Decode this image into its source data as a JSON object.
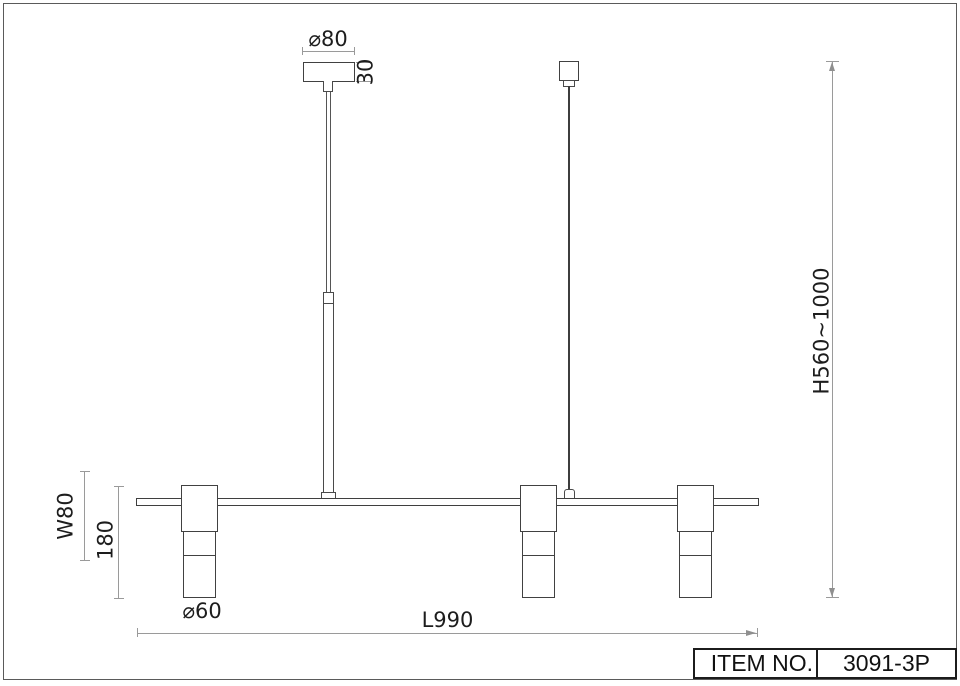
{
  "colors": {
    "background": "#ffffff",
    "object_line": "#414141",
    "dimension_line": "#9a9a9a",
    "text": "#1d1d1d"
  },
  "dimensions": {
    "canopy_diameter": "⌀80",
    "canopy_height": "30",
    "suspension_height": "H560~1000",
    "head_width": "W80",
    "head_height": "180",
    "shade_diameter": "⌀60",
    "bar_length": "L990"
  },
  "title_block": {
    "label": "ITEM NO.",
    "value": "3091-3P"
  }
}
